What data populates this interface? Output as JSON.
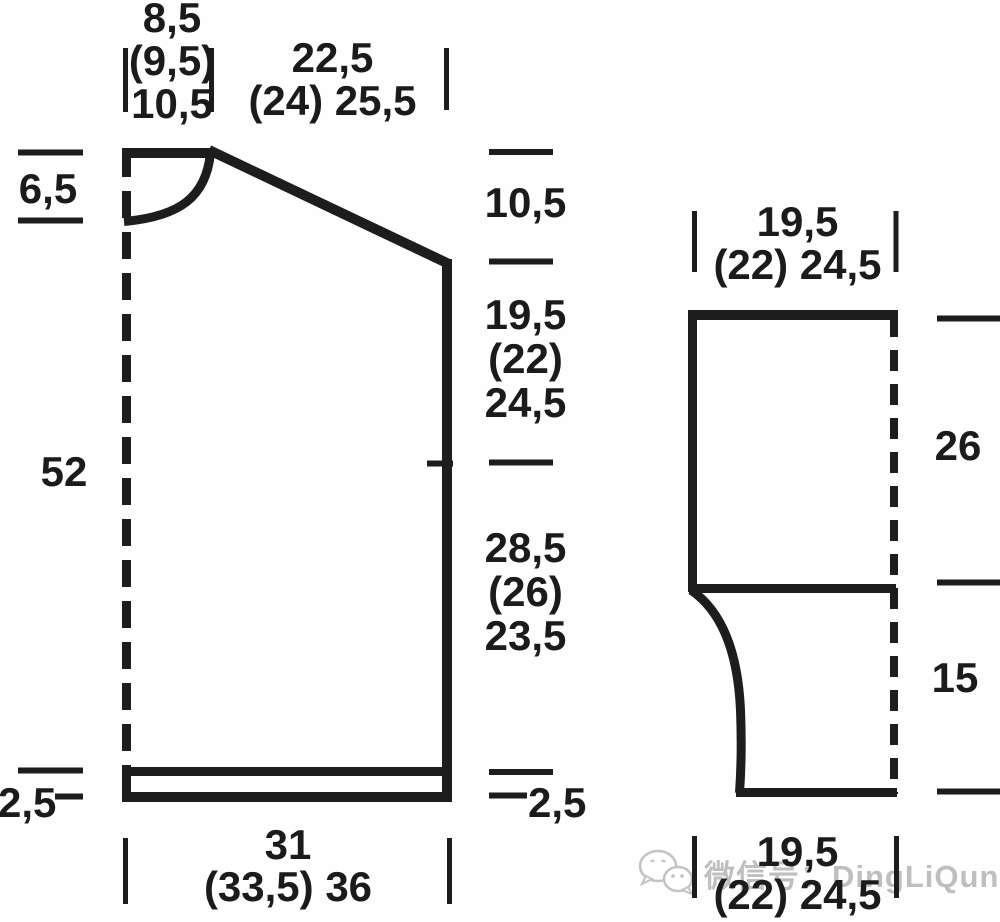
{
  "body_piece": {
    "neck_width": {
      "l1": "8,5",
      "l2": "(9,5)",
      "l3": "10,5"
    },
    "shoulder_width": {
      "l1": "22,5",
      "l2": "(24) 25,5"
    },
    "neck_depth": "6,5",
    "total_length": "52",
    "rib_height_left": "2,5",
    "shoulder_drop": "10,5",
    "armhole_depth": {
      "l1": "19,5",
      "l2": "(22)",
      "l3": "24,5"
    },
    "side_length": {
      "l1": "28,5",
      "l2": "(26)",
      "l3": "23,5"
    },
    "rib_height_right": "2,5",
    "bottom_width": {
      "l1": "31",
      "l2": "(33,5) 36"
    }
  },
  "sleeve_piece": {
    "top_width": {
      "l1": "19,5",
      "l2": "(22) 24,5"
    },
    "upper_length": "26",
    "lower_length": "15",
    "bottom_width": {
      "l1": "19,5",
      "l2": "(22) 24,5"
    }
  },
  "watermark": {
    "label": "微信号：DingLiQun0830"
  },
  "colors": {
    "line": "#1d1d1d",
    "watermark": "#bfbfbf"
  }
}
